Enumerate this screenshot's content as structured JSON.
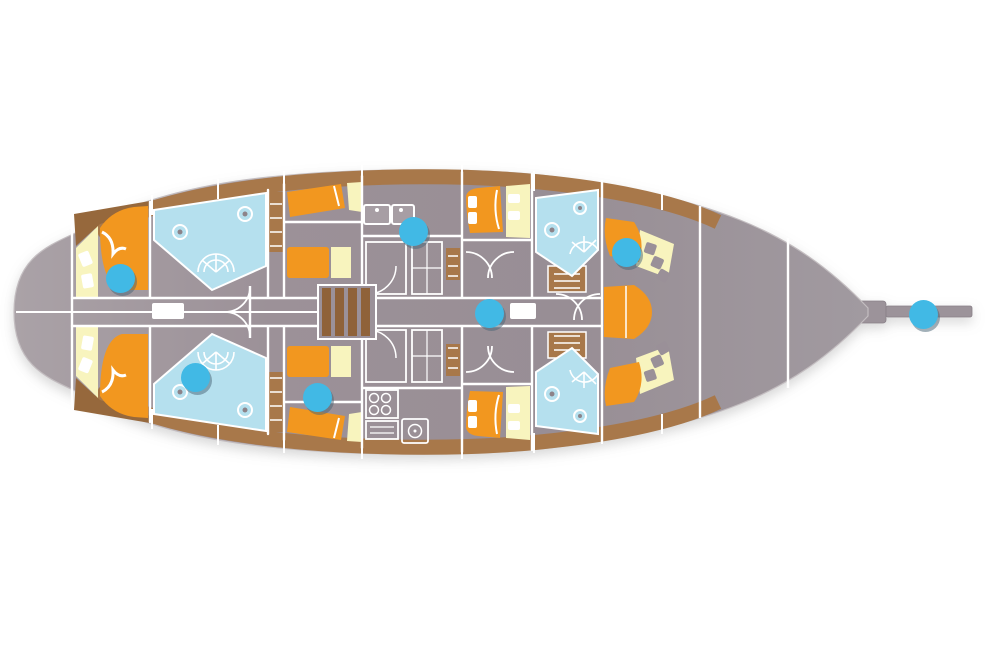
{
  "canvas": {
    "width": 1000,
    "height": 668,
    "background": "#ffffff"
  },
  "colors": {
    "hullA": "#aaa2a7",
    "hullB": "#9c9198",
    "hullC": "#988e95",
    "hullD": "#a19aa0",
    "band": "#a8784a",
    "bandDark": "#96683c",
    "stairs": "#8f6239",
    "orange": "#f2971f",
    "yellow": "#f8f4be",
    "blue": "#b5e0ee",
    "wall": "#ffffff",
    "fixture": "#8d8389",
    "outline": "#c3bdc0",
    "marker": "#41b9e5",
    "markerShadow": "rgba(72,99,117,0.5)"
  },
  "marker": {
    "diameter": 29
  },
  "hotspots": [
    {
      "id": 1,
      "x": 120,
      "y": 278
    },
    {
      "id": 2,
      "x": 195,
      "y": 377
    },
    {
      "id": 3,
      "x": 317,
      "y": 397
    },
    {
      "id": 4,
      "x": 413,
      "y": 231
    },
    {
      "id": 5,
      "x": 489,
      "y": 313
    },
    {
      "id": 6,
      "x": 626,
      "y": 252
    },
    {
      "id": 7,
      "x": 923,
      "y": 314
    }
  ]
}
